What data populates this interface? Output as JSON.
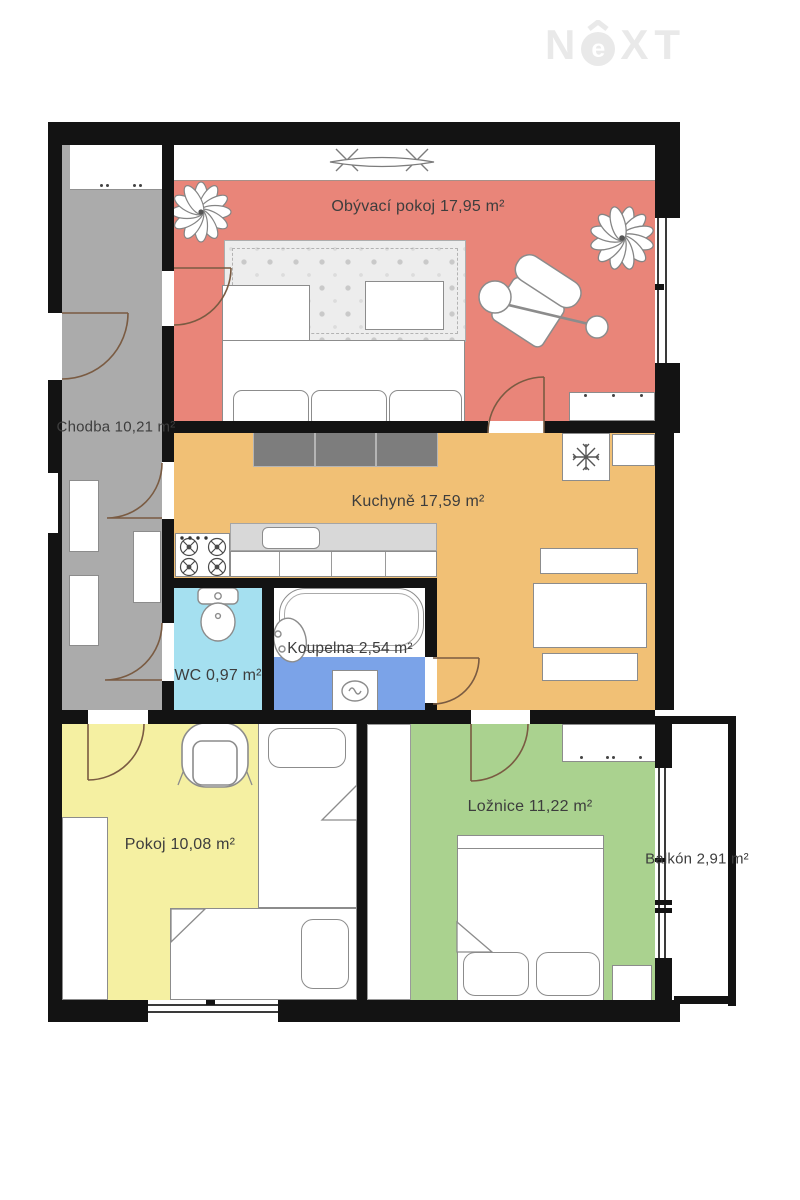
{
  "logo": {
    "text": "NEXT",
    "n": "N",
    "e": "e",
    "x": "X",
    "t": "T"
  },
  "rooms": [
    {
      "id": "living-room",
      "label": "Obývací pokoj 17,95 m²",
      "color": "#e98579"
    },
    {
      "id": "hallway",
      "label": "Chodba 10,21 m²",
      "color": "#ababab"
    },
    {
      "id": "kitchen",
      "label": "Kuchyně 17,59 m²",
      "color": "#f1c075"
    },
    {
      "id": "wc",
      "label": "WC 0,97 m²",
      "color": "#a5e0f0"
    },
    {
      "id": "bathroom",
      "label": "Koupelna 2,54 m²",
      "color": "#7ba3e8"
    },
    {
      "id": "room",
      "label": "Pokoj 10,08 m²",
      "color": "#f5f0a2"
    },
    {
      "id": "bedroom",
      "label": "Ložnice 11,22 m²",
      "color": "#aad28f"
    },
    {
      "id": "balcony",
      "label": "Balkón 2,91 m²",
      "color": "#ffffff"
    }
  ],
  "colors": {
    "wall": "#131313",
    "text": "#3d3d3d",
    "door_arc": "#7a5b42",
    "logo": "#e9e9e9",
    "furniture_outline": "#8c8c8c",
    "rug_base": "#ededed",
    "cabinet_dark": "#7d7d7d",
    "counter_top": "#d8d8d8"
  }
}
